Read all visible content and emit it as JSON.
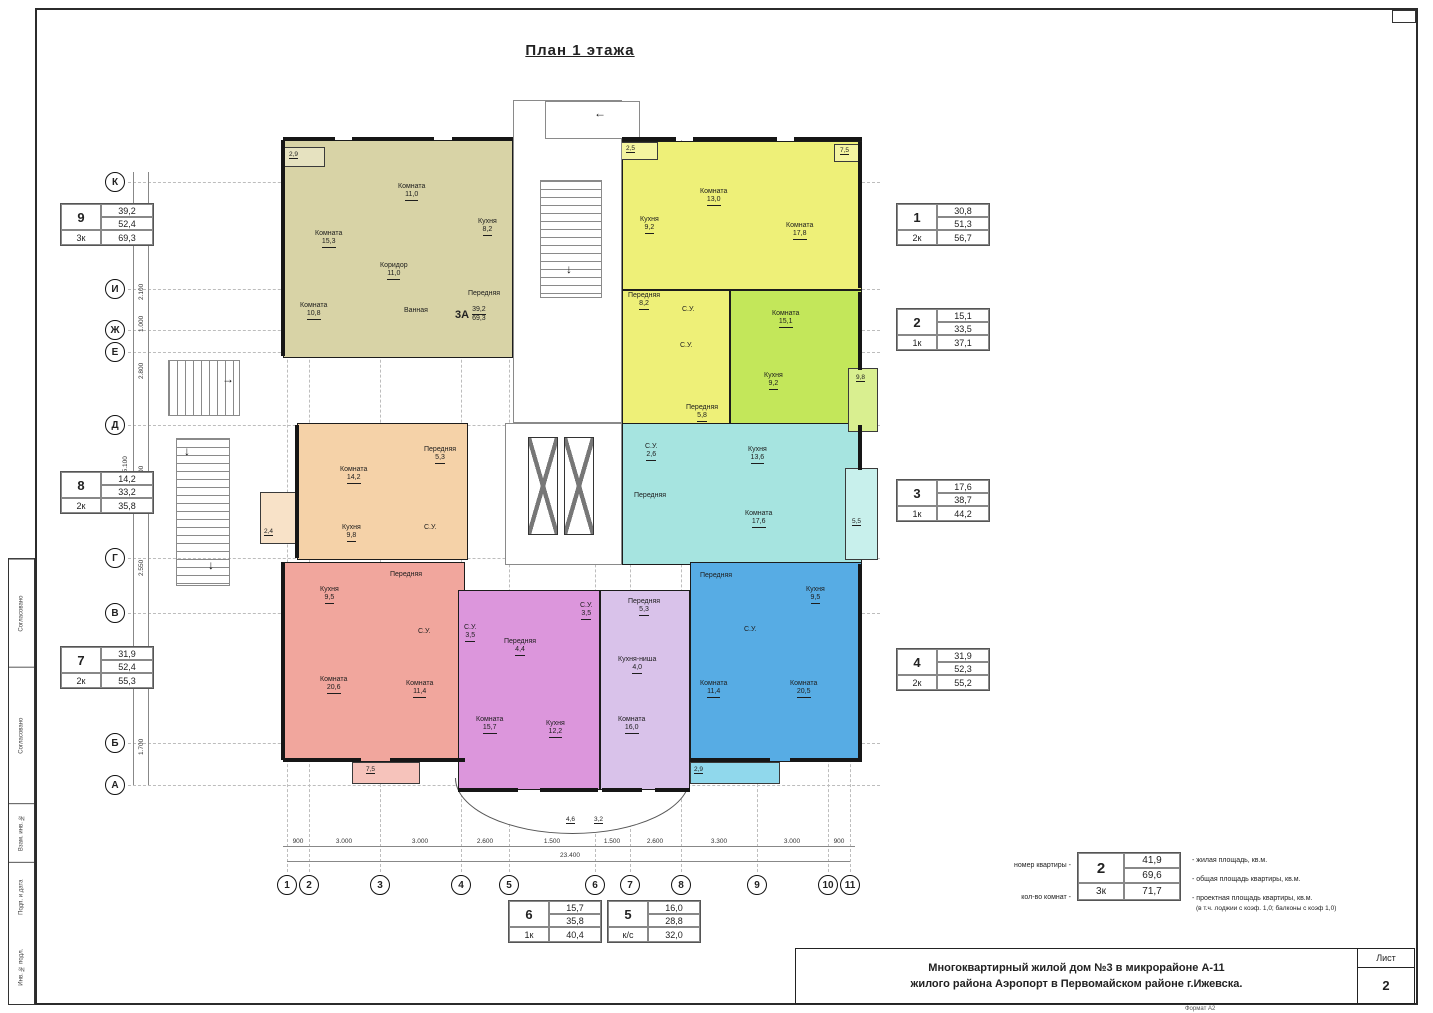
{
  "title": "План 1 этажа",
  "frame": {
    "stamp_labels": [
      "Согласовано",
      "Согласовано",
      "Взам. инв. №",
      "Подп. и дата",
      "Инв. № подл."
    ],
    "format_note": "Формат А2"
  },
  "title_block": {
    "line1": "Многоквартирный жилой дом №3 в микрорайоне А-11",
    "line2": "жилого района Аэропорт в Первомайском районе г.Ижевска.",
    "sheet_label": "Лист",
    "sheet_number": "2"
  },
  "legend": {
    "num_label": "номер квартиры -",
    "rooms_label": "кол-во комнат -",
    "box": {
      "num": "2",
      "living": "41,9",
      "total": "69,6",
      "rooms": "3к",
      "project": "71,7"
    },
    "desc1": "- жилая площадь, кв.м.",
    "desc2": "- общая площадь квартиры, кв.м.",
    "desc3": "- проектная площадь квартиры, кв.м.",
    "desc4": "(в т.ч. лоджии с коэф. 1,0; балконы с коэф 1,0)"
  },
  "axes": {
    "left": [
      "К",
      "И",
      "Ж",
      "Е",
      "Д",
      "Г",
      "В",
      "Б",
      "А"
    ],
    "bottom": [
      "1",
      "2",
      "3",
      "4",
      "5",
      "6",
      "7",
      "8",
      "9",
      "10",
      "11"
    ],
    "left_dims": [
      "4.200",
      "2.100",
      "1.000",
      "2.800",
      "5.500",
      "2.550",
      "5.150",
      "1.700"
    ],
    "left_total": "25.100",
    "bottom_dims": [
      "900",
      "3.000",
      "3.000",
      "2.600",
      "1.500",
      "1.500",
      "2.600",
      "3.300",
      "3.000",
      "900"
    ],
    "bottom_total": "23.400"
  },
  "info_boxes": [
    {
      "num": "9",
      "living": "39,2",
      "total": "52,4",
      "rooms": "3к",
      "project": "69,3"
    },
    {
      "num": "8",
      "living": "14,2",
      "total": "33,2",
      "rooms": "2к",
      "project": "35,8"
    },
    {
      "num": "7",
      "living": "31,9",
      "total": "52,4",
      "rooms": "2к",
      "project": "55,3"
    },
    {
      "num": "1",
      "living": "30,8",
      "total": "51,3",
      "rooms": "2к",
      "project": "56,7"
    },
    {
      "num": "2",
      "living": "15,1",
      "total": "33,5",
      "rooms": "1к",
      "project": "37,1"
    },
    {
      "num": "3",
      "living": "17,6",
      "total": "38,7",
      "rooms": "1к",
      "project": "44,2"
    },
    {
      "num": "4",
      "living": "31,9",
      "total": "52,3",
      "rooms": "2к",
      "project": "55,2"
    },
    {
      "num": "6",
      "living": "15,7",
      "total": "35,8",
      "rooms": "1к",
      "project": "40,4"
    },
    {
      "num": "5",
      "living": "16,0",
      "total": "28,8",
      "rooms": "к/с",
      "project": "32,0"
    }
  ],
  "unit_label": {
    "id": "3А",
    "living": "39,2",
    "total": "69,3"
  },
  "rooms": [
    {
      "t": "Комната",
      "a": "15,3"
    },
    {
      "t": "Комната",
      "a": "11,0"
    },
    {
      "t": "Комната",
      "a": "10,8"
    },
    {
      "t": "Коридор",
      "a": "11,0"
    },
    {
      "t": "Кухня",
      "a": "8,2"
    },
    {
      "t": "Передняя"
    },
    {
      "t": "Ванная"
    },
    {
      "t": "Кухня",
      "a": "9,2"
    },
    {
      "t": "Комната",
      "a": "13,0"
    },
    {
      "t": "Комната",
      "a": "17,8"
    },
    {
      "t": "Передняя",
      "a": "8,2"
    },
    {
      "t": "С.У."
    },
    {
      "t": "Комната",
      "a": "15,1"
    },
    {
      "t": "Кухня",
      "a": "9,2"
    },
    {
      "t": "Передняя",
      "a": "5,8"
    },
    {
      "t": "С.У."
    },
    {
      "t": "Комната",
      "a": "14,2"
    },
    {
      "t": "Кухня",
      "a": "9,8"
    },
    {
      "t": "Передняя",
      "a": "5,3"
    },
    {
      "t": "С.У."
    },
    {
      "t": "Кухня",
      "a": "13,6"
    },
    {
      "t": "Комната",
      "a": "17,6"
    },
    {
      "t": "Передняя"
    },
    {
      "t": "С.У.",
      "a": "2,6"
    },
    {
      "t": "Кухня",
      "a": "9,5"
    },
    {
      "t": "Передняя"
    },
    {
      "t": "С.У."
    },
    {
      "t": "Комната",
      "a": "20,6"
    },
    {
      "t": "Комната",
      "a": "11,4"
    },
    {
      "t": "С.У.",
      "a": "3,5"
    },
    {
      "t": "Передняя",
      "a": "4,4"
    },
    {
      "t": "Комната",
      "a": "15,7"
    },
    {
      "t": "Кухня",
      "a": "12,2"
    },
    {
      "t": "С.У.",
      "a": "3,5"
    },
    {
      "t": "Передняя",
      "a": "5,3"
    },
    {
      "t": "Кухня-ниша",
      "a": "4,0"
    },
    {
      "t": "Комната",
      "a": "16,0"
    },
    {
      "t": "Передняя"
    },
    {
      "t": "Кухня",
      "a": "9,5"
    },
    {
      "t": "С.У."
    },
    {
      "t": "Комната",
      "a": "11,4"
    },
    {
      "t": "Комната",
      "a": "20,5"
    }
  ],
  "balcony_labels": [
    "2,9",
    "2,5",
    "7,5",
    "9,8",
    "5,5",
    "2,4",
    "7,5",
    "2,9",
    "4,6",
    "3,2"
  ]
}
